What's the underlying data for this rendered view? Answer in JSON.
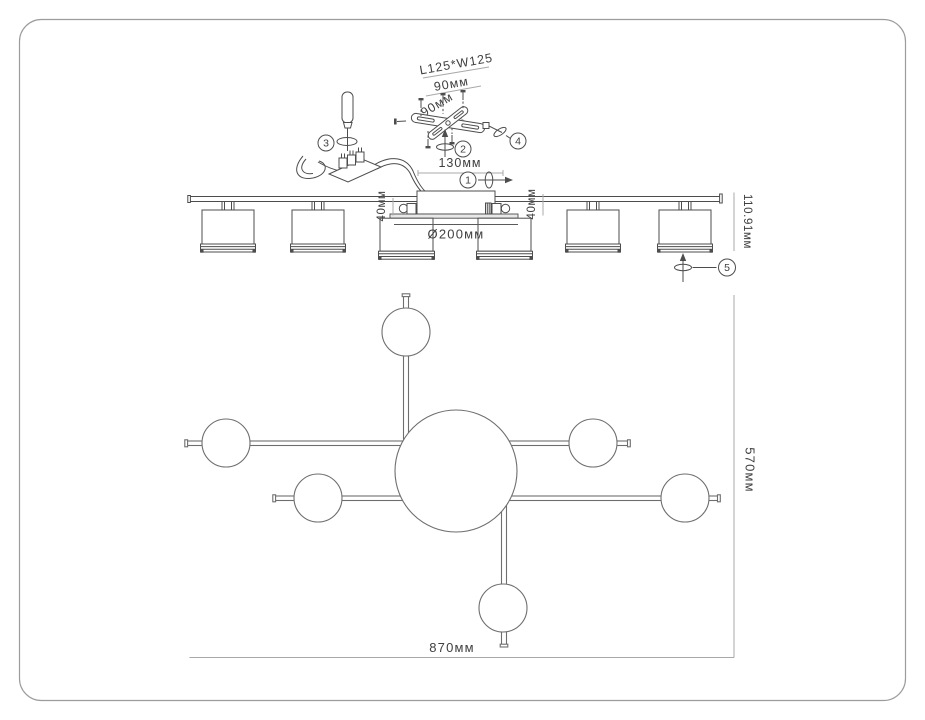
{
  "labels": {
    "bracket_size": "L125*W125",
    "bracket_width_mm": "90мм",
    "bracket_depth_mm": "90мм",
    "canopy_length": "130мм",
    "offset_left": "40мм",
    "offset_right": "40мм",
    "shade_diameter": "Ø200мм",
    "fixture_height": "110.91мм",
    "plan_width": "870мм",
    "plan_depth": "570мм"
  },
  "steps": [
    "1",
    "2",
    "3",
    "4",
    "5"
  ],
  "colors": {
    "drawing_line": "#4d4d4d",
    "plan_line": "#6e6e6e",
    "dimension_line": "#a8a8a8",
    "text": "#3f3f3f",
    "page_border": "#9c9c9c",
    "background": "#ffffff"
  }
}
